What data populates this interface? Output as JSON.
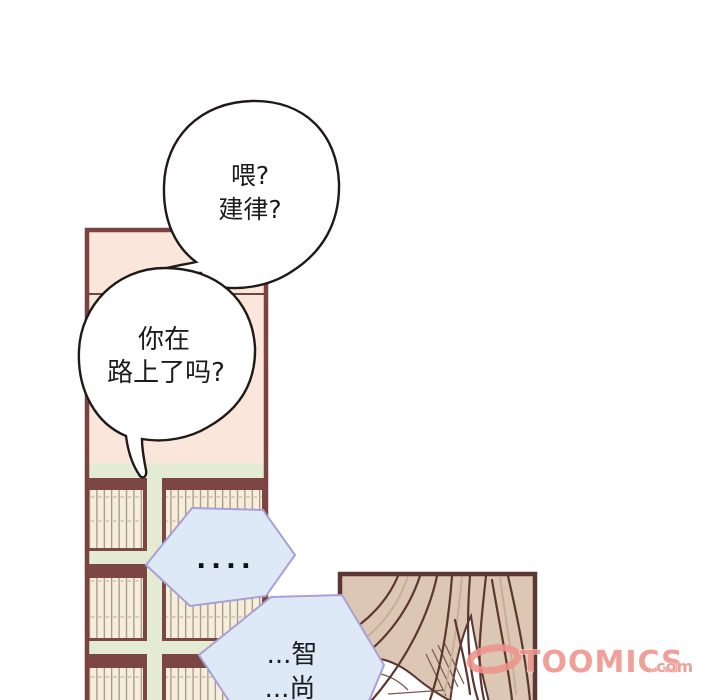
{
  "comic": {
    "speech_bubble_1": {
      "line1": "喂?",
      "line2": "建律?"
    },
    "speech_bubble_2": {
      "line1": "你在",
      "line2": "路上了吗?"
    },
    "thought_hex_1": {
      "line1": "...."
    },
    "thought_hex_2": {
      "line1": "...智",
      "line2": "...尚"
    }
  },
  "watermark": {
    "brand": "TOOMICS",
    "suffix": ".com",
    "color": "#ef938c"
  },
  "colors": {
    "panel_wall_pink": "#fbe6dc",
    "frame_maroon": "#7a4340",
    "shelf_green": "#e3ecd2",
    "book_cream": "#f4eedb",
    "hex_fill_blue": "#dee9f8",
    "hex_border_purple": "#a9a0d6",
    "hair_tan": "#dcc7b4",
    "hair_line": "#5d3531",
    "bubble_outline": "#1f1a18"
  }
}
